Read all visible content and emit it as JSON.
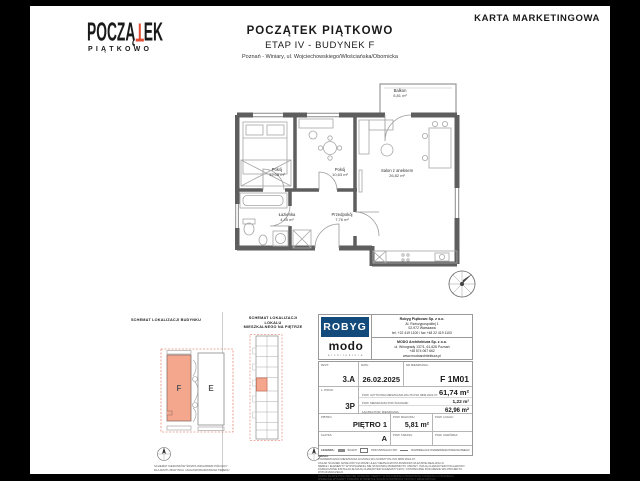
{
  "page": {
    "doc_type": "KARTA MARKETINGOWA"
  },
  "header": {
    "logo_part1": "POCZĄ",
    "logo_accent": "T",
    "logo_part2": "EK",
    "logo_sub": "PIĄTKOWO",
    "title": "POCZĄTEK PIĄTKOWO",
    "subtitle": "ETAP IV - BUDYNEK F",
    "address": "Poznań - Winiary, ul. Wojciechowskiego/Włościańska/Obornicka"
  },
  "plan": {
    "rooms": [
      {
        "name": "Pokój",
        "area": "12,08 m²"
      },
      {
        "name": "Pokój",
        "area": "10,63 m²"
      },
      {
        "name": "Salon z aneksem",
        "area": "26,82 m²"
      },
      {
        "name": "Łazienka",
        "area": "4,45 m²"
      },
      {
        "name": "Przedpokój",
        "area": "7,76 m²"
      },
      {
        "name": "Balkon",
        "area": "5,81 m²"
      }
    ]
  },
  "location": {
    "building_schematic_label": "SCHEMAT LOKALIZACJI BUDYNKU",
    "floor_schematic_label_line1": "SCHEMAT LOKALIZACJI LOKALU",
    "floor_schematic_label_line2": "MIESZKALNEGO NA PIĘTRZE",
    "building_f": "F",
    "building_e": "E",
    "compass_note_line1": "SCHEMAT KIERUNKÓW ŚWIATA WZGLĘDEM PÓŁNOCY",
    "compass_note_line2": "DLA RZUTU BUDYNKU I ZAGOSPODAROWANIA TERENU"
  },
  "companies": {
    "developer_logo": "ROBYG",
    "architect_logo": "modo",
    "architect_logo_sub": "architektura",
    "developer_name": "Robyg Piątkowo Sp. z o.o.",
    "developer_address1": "Al. Rzeczypospolitej 1",
    "developer_address2": "02-972 Warszawa",
    "developer_phone": "tel. +22 419 1100 / fax +48 22 419 1103",
    "architect_name": "MODO Architektura Sp. z o.o.",
    "architect_address": "ul. Winogrady 137/1, 61-626 Poznań",
    "architect_phone": "+48 574 067 662",
    "architect_web": "www.modoarchitektura.pl"
  },
  "details": {
    "rzut_label": "RZUT:",
    "rzut": "3.A",
    "data_label": "DATA:",
    "data": "26.02.2025",
    "nr_label": "NR MIESZKANIA:",
    "nr": "F 1M01",
    "pokoi_label": "L. POKOI:",
    "pokoi": "3P",
    "pow_uzytkowa_label": "POW. UŻYTKOWA MIESZKANIA WG PN-ISO 9836:2022-07:",
    "pow_uzytkowa": "61,74 m²",
    "pow_scianami_label": "POW. MIESZKANIA POD ŚCIANAMI:",
    "pow_scianami": "1,22 m²",
    "laczna_label": "ŁĄCZNA POW. MIESZKANIA:",
    "laczna": "62,96 m²",
    "pietro_label": "PIĘTRO:",
    "pietro": "PIĘTRO 1",
    "balkon_label": "POW. BALKONU:",
    "balkon": "5,81 m²",
    "loggia_label": "POW. LOGGII:",
    "loggia": "",
    "klatka_label": "KLATKA:",
    "klatka": "A",
    "taras_label": "POW. TARASU:",
    "taras": "",
    "ogrodek_label": "POW. OGRÓDKA:",
    "ogrodek": ""
  },
  "legend": {
    "label": "LEGENDA:",
    "item1": "ŚCIANY",
    "item2": "PION INSTALACYJNY",
    "item3": "ROZDZIELACZ OGRZEWANIA PODŁOGOWEGO"
  },
  "notes": {
    "label": "UWAGI:",
    "line1": "POWIERZCHNIA MIESZKANIA LICZONA WG NORMY PN-ISO 9836:2022-07.",
    "line2": "UKŁAD ŚCIANEK DZIAŁOWYCH MOŻE ULEC NIEZNACZNYM ZMIANOM NA ETAPIE REALIZACJI.",
    "line3": "MEBLE I ELEMENTY WYPOSAŻENIA NIE STANOWIĄ PRZEDMIOTU UMOWY I MAJĄ CHARAKTER POGLĄDOWY.",
    "line4": "ZAZNACZONE INSTALACJE MAJĄ CHARAKTER SCHEMATYCZNY, OSTATECZNE POŁOŻENIE WG PROJEKTU WYKONAWCZEGO.",
    "line5": "KARTA MARKETINGOWA NIE STANOWI OFERTY W ROZUMIENIU PRZEPISÓW KODEKSU CYWILNEGO.",
    "line6": "WSZELKIE WYMIARY PODANO W ŚWIETLE ŚCIAN KONSTRUKCYJNYCH I DZIAŁOWYCH."
  },
  "colors": {
    "accent_red": "#e14b32",
    "robyg_blue": "#134a7c",
    "highlight_salmon": "#f5a78e"
  }
}
